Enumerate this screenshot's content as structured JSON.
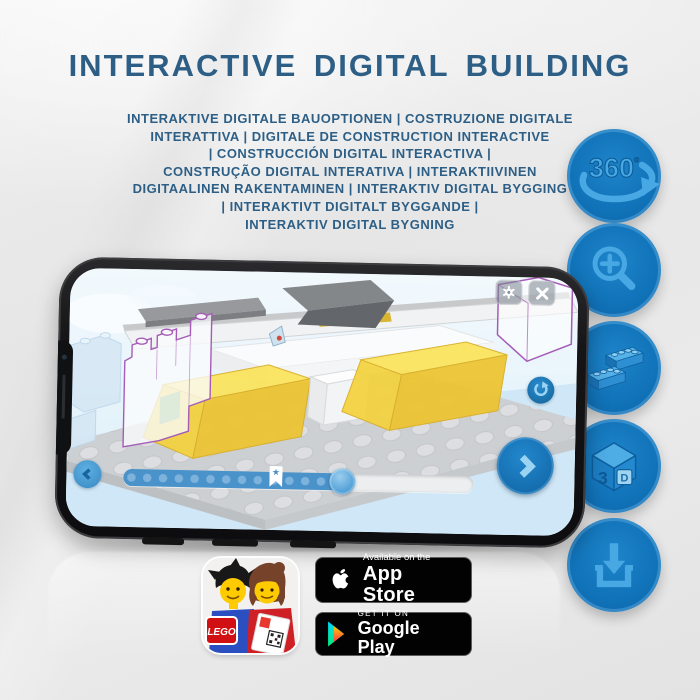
{
  "header": {
    "title": "INTERACTIVE DIGITAL BUILDING",
    "subtitle_lines": [
      "INTERAKTIVE DIGITALE BAUOPTIONEN | COSTRUZIONE DIGITALE",
      "INTERATTIVA | DIGITALE DE CONSTRUCTION INTERACTIVE",
      "| CONSTRUCCIÓN DIGITAL INTERACTIVA |",
      "CONSTRUÇÃO DIGITAL INTERATIVA | INTERAKTIIVINEN",
      "DIGITAALINEN RAKENTAMINEN | INTERAKTIV DIGITAL BYGGING",
      "| INTERAKTIVT DIGITALT BYGGANDE |",
      "INTERAKTIV DIGITAL BYGNING"
    ]
  },
  "feature_badges": {
    "labels": {
      "rotation": "360",
      "degree": "º",
      "cube_left": "3",
      "cube_right": "D"
    },
    "items": [
      {
        "name": "360-rotation-icon"
      },
      {
        "name": "zoom-in-icon"
      },
      {
        "name": "brick-stack-icon"
      },
      {
        "name": "3d-cube-icon"
      },
      {
        "name": "download-icon"
      }
    ]
  },
  "phone": {
    "ui_icons": [
      "gear-icon",
      "close-icon",
      "rotate-icon",
      "back-chevron-icon",
      "next-chevron-icon",
      "bookmark-star-icon"
    ]
  },
  "icons": {
    "bookmark_star_glyph": "★"
  },
  "store": {
    "lego_app_logo": "LEGO",
    "app_store": {
      "line1": "Available on the",
      "line2": "App Store"
    },
    "google_play": {
      "line1": "GET IT ON",
      "line2": "Google Play"
    }
  },
  "colors": {
    "title_blue": "#2d5f86",
    "circle_blue": "#1173b9",
    "glyph_blue": "#48a8e4",
    "brick_yellow": "#f6dd4e",
    "progress_blue": "#4a92ca",
    "badge_black": "#020202"
  }
}
